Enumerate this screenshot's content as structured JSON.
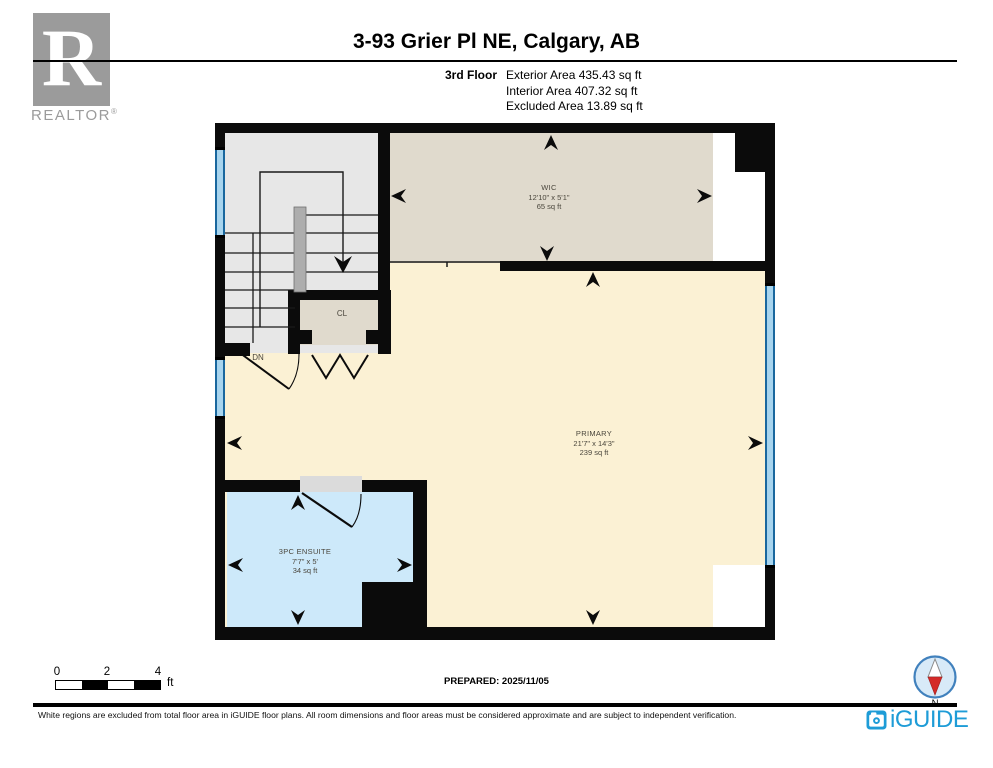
{
  "header": {
    "realtor_letter": "R",
    "realtor_word": "REALTOR",
    "realtor_reg": "®",
    "title": "3-93 Grier Pl NE, Calgary, AB",
    "floor_label": "3rd Floor",
    "area_lines": [
      "Exterior Area 435.43 sq ft",
      "Interior Area 407.32 sq ft",
      "Excluded Area 13.89 sq ft"
    ]
  },
  "rooms": {
    "wic": {
      "name": "WIC",
      "dims": "12'10\" x 5'1\"",
      "area": "65 sq ft"
    },
    "primary": {
      "name": "PRIMARY",
      "dims": "21'7\" x 14'3\"",
      "area": "239 sq ft"
    },
    "ensuite": {
      "name": "3PC ENSUITE",
      "dims": "7'7\" x 5'",
      "area": "34 sq ft"
    },
    "closet": {
      "name": "CL"
    },
    "stairs": {
      "direction_label": "DN"
    }
  },
  "scale_bar": {
    "ticks": [
      "0",
      "2",
      "4"
    ],
    "unit": "ft"
  },
  "prepared": "PREPARED: 2025/11/05",
  "compass": {
    "north_label": "N"
  },
  "brand": {
    "name": "iGUIDE"
  },
  "disclaimer": "White regions are excluded from total floor area in iGUIDE floor plans. All room dimensions and floor areas must be considered approximate and are subject to independent verification.",
  "colors": {
    "wall": "#0b0b0b",
    "primary_room": "#fbf1d4",
    "wic_room": "#e0dacd",
    "ensuite_room": "#cde9fa",
    "stairwell": "#e7e7e7",
    "window_blue": "#8cc6e8",
    "brand_blue": "#1e9cd7",
    "compass_red": "#d42a28",
    "realtor_gray": "#9b9b9b"
  }
}
